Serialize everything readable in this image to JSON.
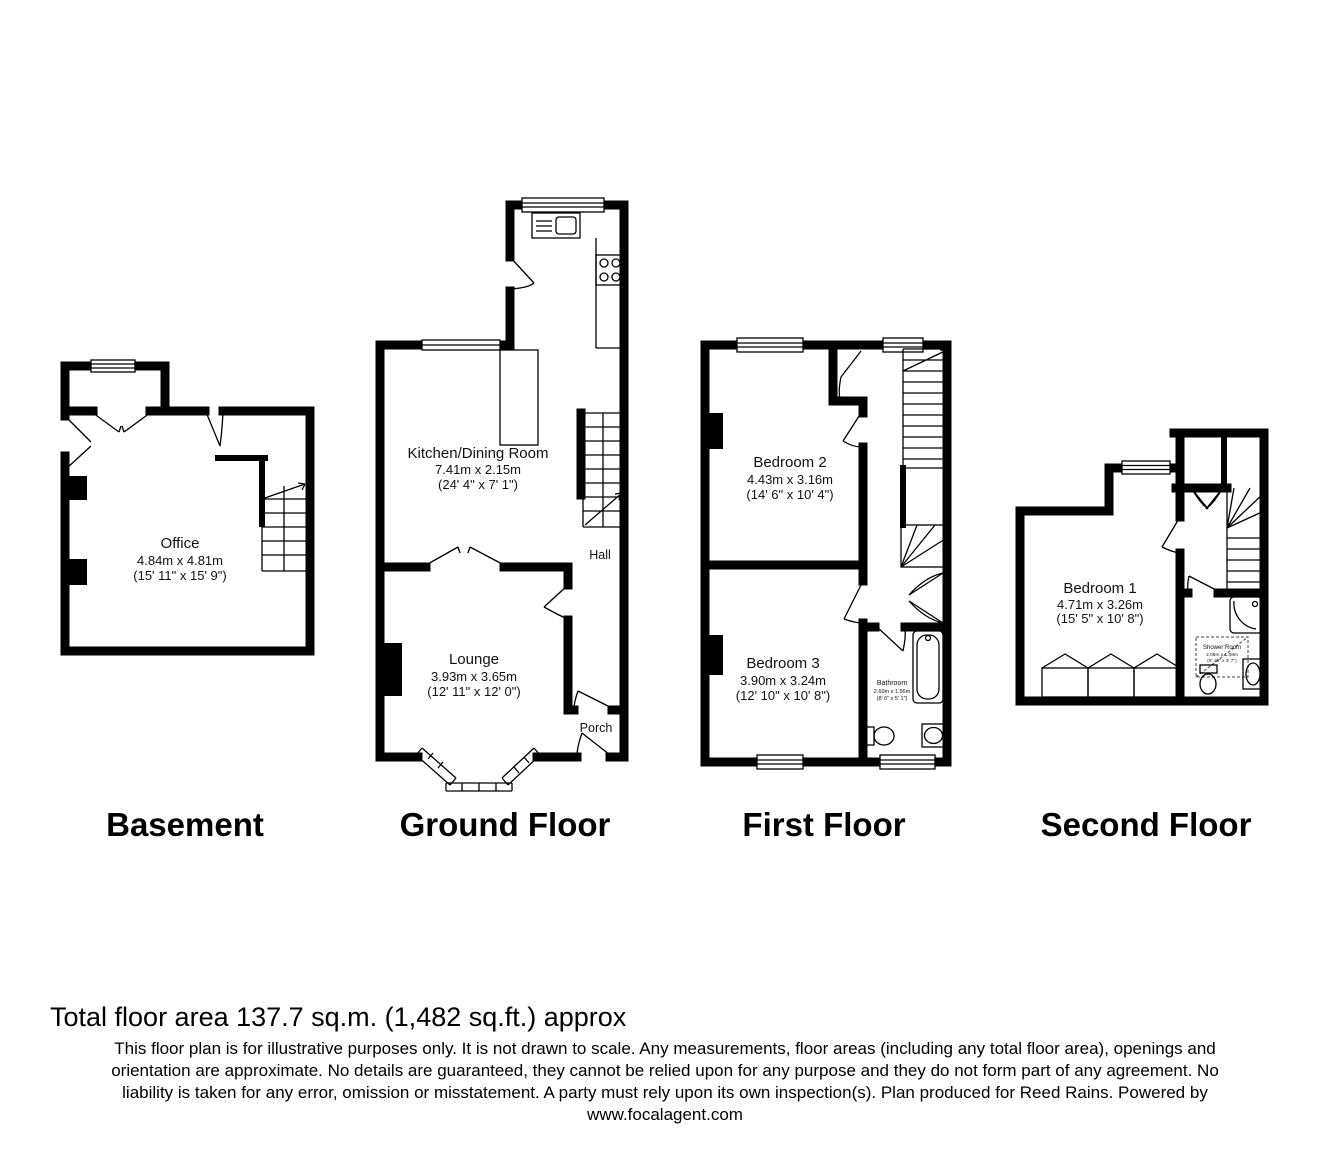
{
  "floors": {
    "basement": {
      "caption": "Basement",
      "rooms": {
        "office": {
          "name": "Office",
          "metric": "4.84m x 4.81m",
          "imperial": "(15' 11\" x 15' 9\")"
        }
      }
    },
    "ground": {
      "caption": "Ground Floor",
      "rooms": {
        "kitchen": {
          "name": "Kitchen/Dining Room",
          "metric": "7.41m x 2.15m",
          "imperial": "(24' 4\" x 7' 1\")"
        },
        "lounge": {
          "name": "Lounge",
          "metric": "3.93m x 3.65m",
          "imperial": "(12' 11\" x 12' 0\")"
        },
        "hall": {
          "name": "Hall"
        },
        "porch": {
          "name": "Porch"
        }
      }
    },
    "first": {
      "caption": "First Floor",
      "rooms": {
        "bedroom2": {
          "name": "Bedroom 2",
          "metric": "4.43m x 3.16m",
          "imperial": "(14' 6\" x 10' 4\")"
        },
        "bedroom3": {
          "name": "Bedroom 3",
          "metric": "3.90m x 3.24m",
          "imperial": "(12' 10\" x 10' 8\")"
        },
        "bathroom": {
          "name": "Bathroom",
          "metric": "2.60m x 1.56m",
          "imperial": "(8' 6\" x 5' 1\")"
        }
      }
    },
    "second": {
      "caption": "Second Floor",
      "rooms": {
        "bedroom1": {
          "name": "Bedroom 1",
          "metric": "4.71m x 3.26m",
          "imperial": "(15' 5\" x 10' 8\")"
        },
        "shower": {
          "name": "Shower Room",
          "metric": "2.08m x 1.08m",
          "imperial": "(6' 10\" x 3' 7\")"
        }
      }
    }
  },
  "footer": {
    "total_area": "Total floor area 137.7 sq.m. (1,482 sq.ft.) approx",
    "disclaimer_line1": "This floor plan is for illustrative purposes only. It is not drawn to scale. Any measurements, floor areas (including any total floor area), openings and",
    "disclaimer_line2": "orientation are approximate. No details are guaranteed, they cannot be relied upon for any purpose and they do not form part of any agreement. No",
    "disclaimer_line3": "liability is taken for any error, omission or misstatement. A party must rely upon its own inspection(s). Plan produced for Reed Rains. Powered by",
    "website": "www.focalagent.com"
  },
  "colors": {
    "wall": "#000000",
    "background": "#ffffff"
  }
}
